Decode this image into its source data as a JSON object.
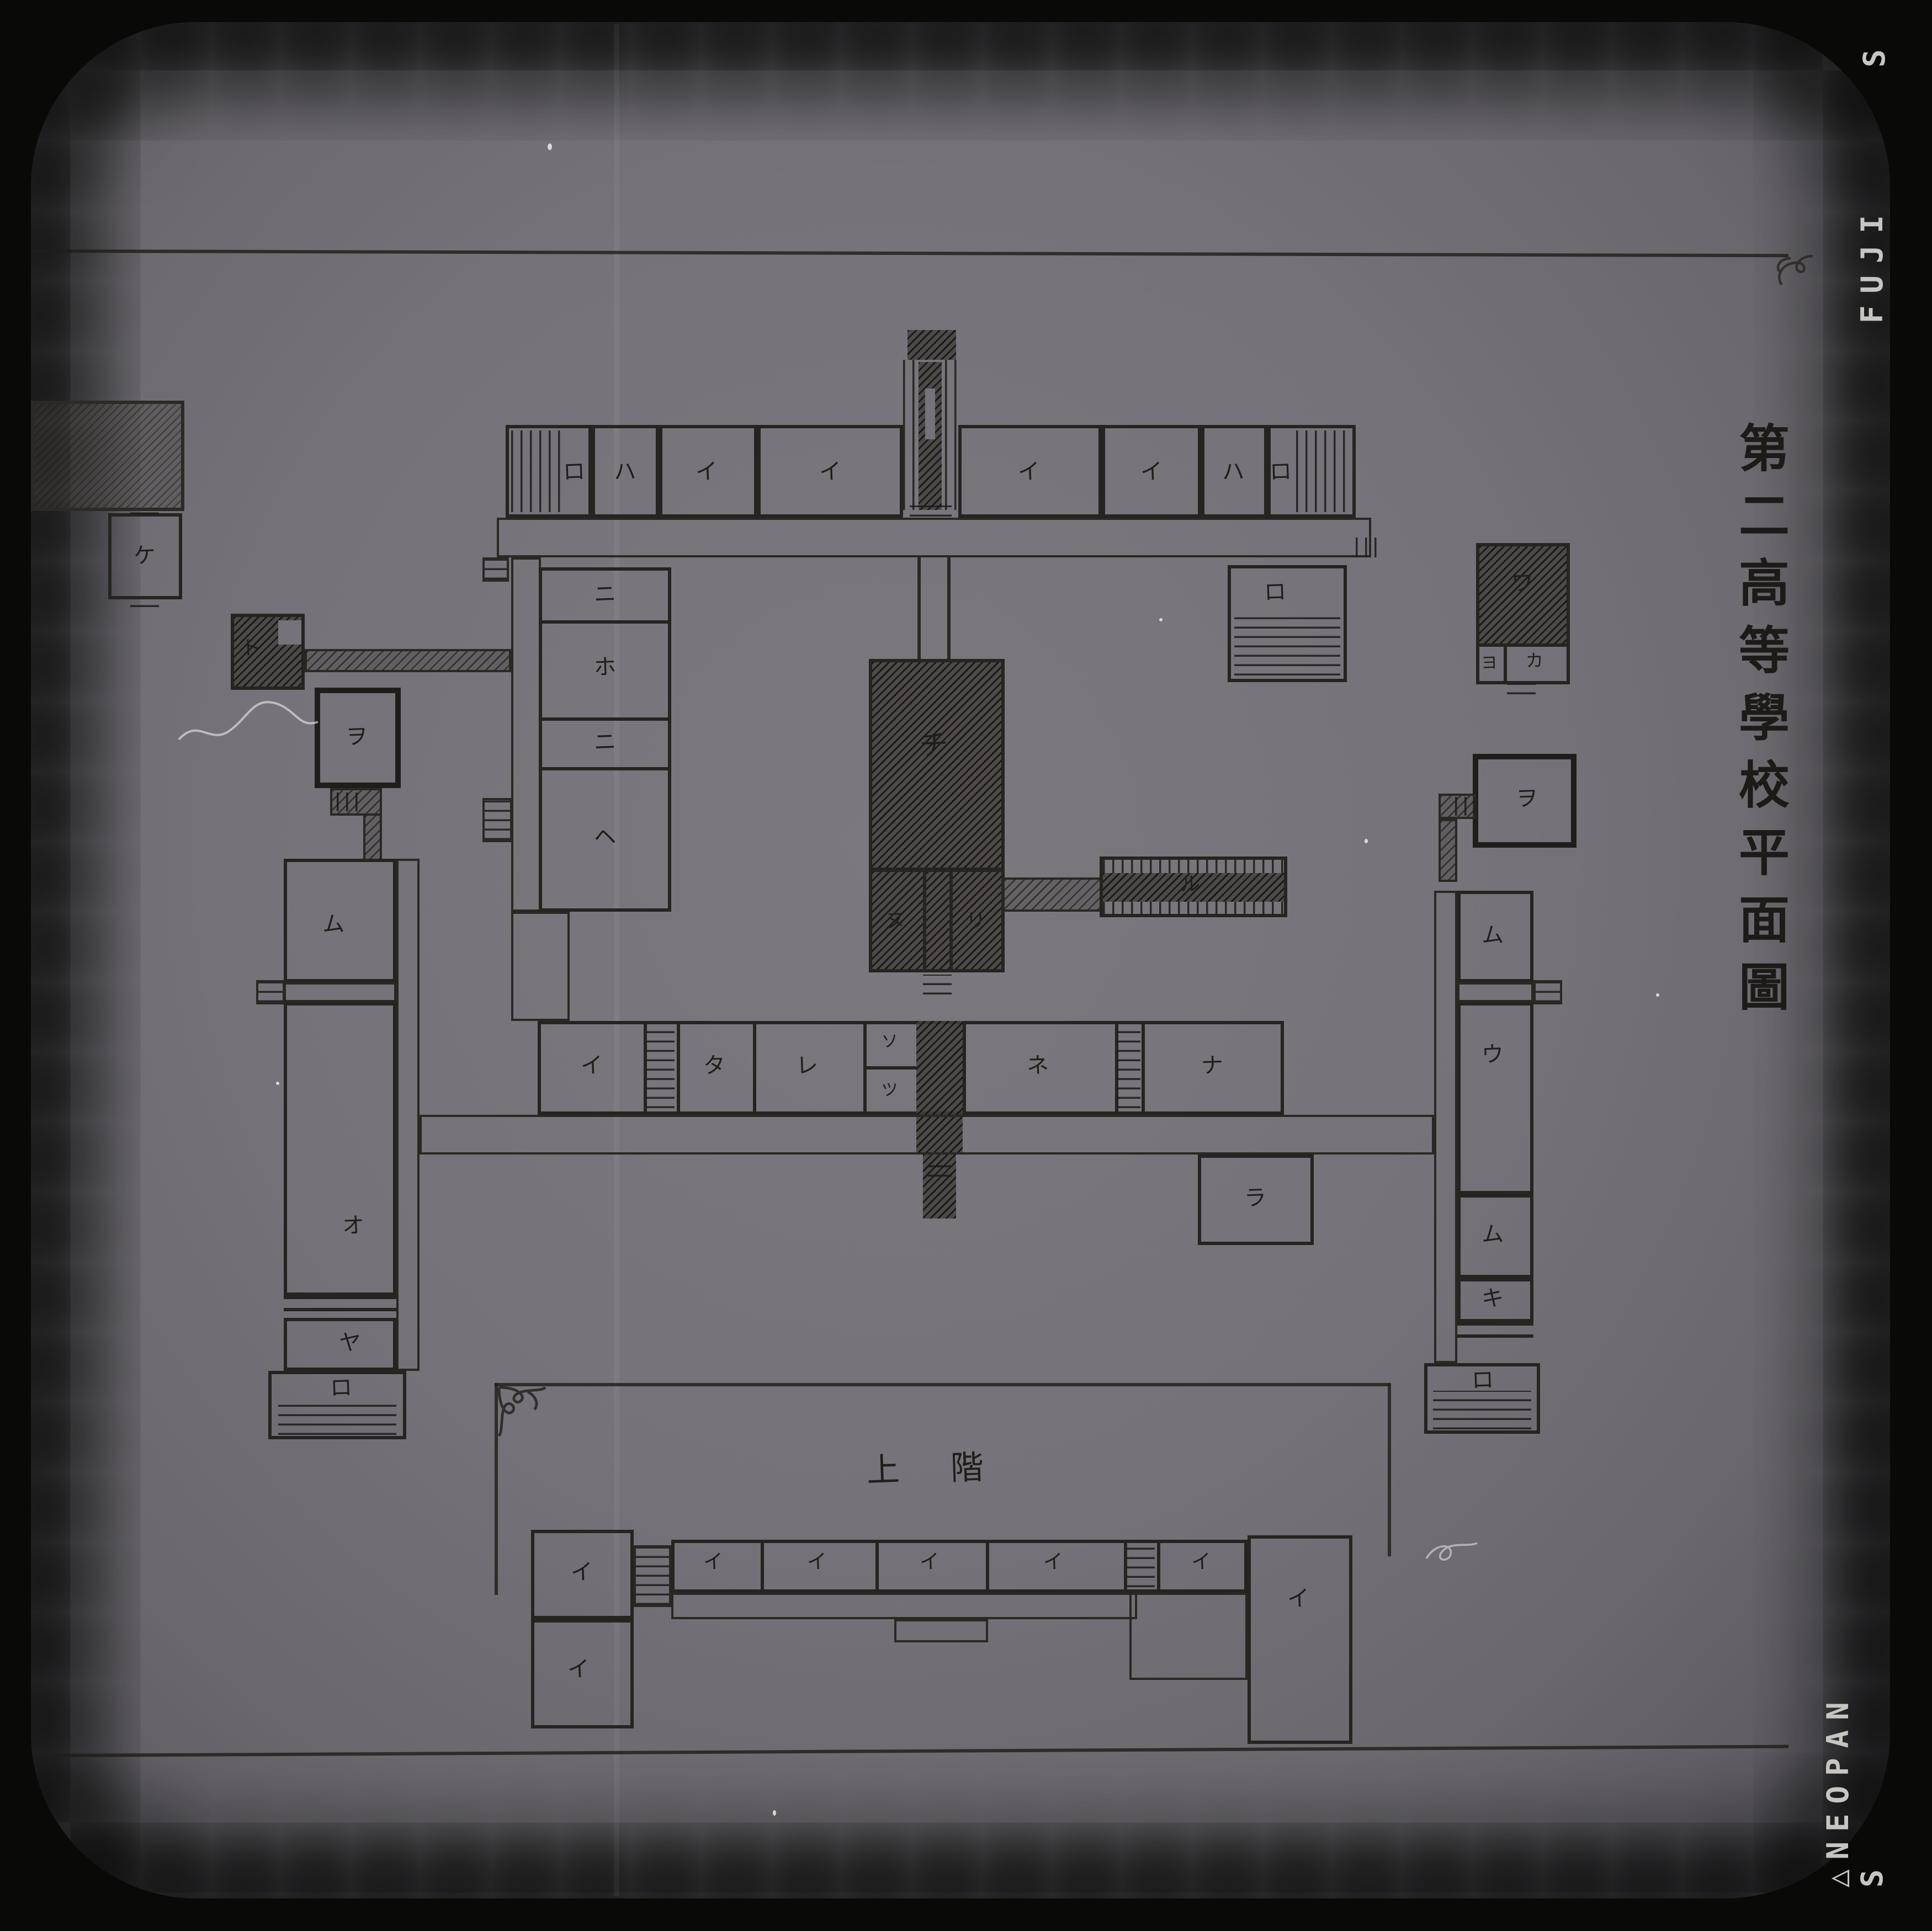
{
  "film": {
    "maker": "FUJI",
    "stock": "△NEOPAN S",
    "edge_partial": "S"
  },
  "title": {
    "text": "第二高等學校平面圖"
  },
  "plan": {
    "floor_note_left": "上",
    "floor_note_right": "階",
    "boxes": [
      [
        "room-ro-northwest",
        "wall",
        458,
        385,
        78,
        84
      ],
      [
        "stairs-stripes-northwest-end",
        "vstripe",
        463,
        390,
        46,
        74
      ],
      [
        "room-ha-northwest",
        "wall",
        536,
        385,
        61,
        84
      ],
      [
        "room-i-north-1",
        "wall",
        597,
        385,
        89,
        84
      ],
      [
        "room-i-north-2",
        "wall",
        686,
        385,
        132,
        84
      ],
      [
        "room-i-north-3",
        "wall",
        868,
        385,
        130,
        84
      ],
      [
        "room-i-north-4",
        "wall",
        998,
        385,
        90,
        84
      ],
      [
        "room-ha-northeast",
        "wall",
        1088,
        385,
        60,
        84
      ],
      [
        "room-ro-northeast",
        "wall",
        1148,
        385,
        80,
        84
      ],
      [
        "stairs-stripes-northeast-end",
        "vstripe",
        1174,
        390,
        48,
        74
      ],
      [
        "corridor-north",
        "wallthin",
        450,
        469,
        792,
        36
      ],
      [
        "stairs-north-left",
        "hstripe-b",
        437,
        505,
        24,
        22
      ],
      [
        "stairs-north-right",
        "vstripe",
        1228,
        487,
        24,
        18
      ],
      [
        "entrance-tower",
        "dark",
        822,
        299,
        44,
        27
      ],
      [
        "entrance-side-left",
        "vstripe",
        818,
        326,
        11,
        136
      ],
      [
        "entrance-side-right",
        "vstripe",
        856,
        326,
        11,
        136
      ],
      [
        "entrance-hall",
        "dark",
        832,
        328,
        21,
        134
      ],
      [
        "entrance-slot",
        "plateBg",
        838,
        352,
        9,
        46
      ],
      [
        "entrance-steps",
        "hstripe",
        824,
        458,
        38,
        10
      ],
      [
        "walkway-wall-left",
        "vline",
        831,
        505,
        3,
        92
      ],
      [
        "walkway-wall-right",
        "vline",
        858,
        505,
        3,
        92
      ],
      [
        "corridor-west-column",
        "wallthin",
        463,
        505,
        27,
        321
      ],
      [
        "corridor-west-column-lower",
        "wallthin",
        463,
        826,
        53,
        99
      ],
      [
        "rooms-west-column",
        "wall",
        488,
        514,
        120,
        312
      ],
      [
        "wall-ni-ho",
        "hwall",
        488,
        562,
        120,
        3
      ],
      [
        "wall-ho-ni",
        "hwall",
        488,
        650,
        120,
        3
      ],
      [
        "wall-ni-he",
        "hwall",
        488,
        695,
        120,
        3
      ],
      [
        "stairs-west-column",
        "hstripe-b",
        437,
        723,
        27,
        40
      ],
      [
        "building-ke",
        "wall",
        98,
        465,
        67,
        78
      ],
      [
        "steps-ke-top",
        "hstripe",
        118,
        458,
        26,
        8
      ],
      [
        "steps-ke-bottom",
        "hstripe",
        118,
        542,
        26,
        8
      ],
      [
        "building-northwest-shed",
        "hatch2b",
        28,
        363,
        139,
        100
      ],
      [
        "building-to",
        "wall dark",
        209,
        556,
        67,
        69
      ],
      [
        "court-to",
        "plateBg",
        252,
        562,
        21,
        22
      ],
      [
        "corridor-to",
        "hatchb",
        276,
        588,
        187,
        21
      ],
      [
        "building-wa-yo-ka",
        "wall",
        1337,
        492,
        85,
        128
      ],
      [
        "room-wa-hatched",
        "dark",
        1340,
        495,
        79,
        88
      ],
      [
        "wall-wa-row",
        "hwall",
        1337,
        583,
        85,
        3
      ],
      [
        "wall-yo-ka",
        "vwall",
        1362,
        583,
        3,
        37
      ],
      [
        "steps-wa",
        "hstripe",
        1365,
        620,
        26,
        9
      ],
      [
        "room-ro-hanging",
        "wall",
        1112,
        512,
        108,
        106
      ],
      [
        "veranda-ro-hanging",
        "hstripe",
        1118,
        556,
        96,
        56
      ],
      [
        "hall-chi",
        "wall dark",
        787,
        597,
        123,
        192
      ],
      [
        "rooms-nu-ri",
        "wall dark",
        787,
        787,
        123,
        94
      ],
      [
        "wall-nu-mid",
        "vwall",
        836,
        787,
        3,
        94
      ],
      [
        "wall-mid-ri",
        "vwall",
        860,
        787,
        3,
        94
      ],
      [
        "steps-chi-south",
        "hstripe",
        836,
        883,
        26,
        18
      ],
      [
        "corridor-ru",
        "hatchb",
        908,
        795,
        90,
        31
      ],
      [
        "building-ru",
        "wall",
        996,
        776,
        170,
        55
      ],
      [
        "ru-window-band-top",
        "vstripe",
        999,
        779,
        164,
        12
      ],
      [
        "ru-hall-center",
        "dark",
        999,
        791,
        164,
        26
      ],
      [
        "ru-window-band-bottom",
        "vstripe",
        999,
        817,
        164,
        11
      ],
      [
        "rooms-middle-wing",
        "wall",
        487,
        925,
        676,
        85
      ],
      [
        "wall-mid-1",
        "vwall",
        583,
        925,
        3,
        85
      ],
      [
        "wall-mid-2",
        "vwall",
        613,
        925,
        3,
        85
      ],
      [
        "wall-mid-3",
        "vwall",
        682,
        925,
        3,
        85
      ],
      [
        "wall-mid-4",
        "vwall",
        782,
        925,
        3,
        85
      ],
      [
        "wall-mid-5",
        "vwall",
        872,
        925,
        3,
        85
      ],
      [
        "wall-mid-6",
        "vwall",
        1010,
        925,
        3,
        85
      ],
      [
        "wall-mid-7",
        "vwall",
        1034,
        925,
        3,
        85
      ],
      [
        "stairs-middle-west",
        "hstripe",
        586,
        932,
        25,
        72
      ],
      [
        "wall-so-tsu",
        "hwall",
        782,
        966,
        48,
        3
      ],
      [
        "connector-middle",
        "dark",
        830,
        925,
        42,
        121
      ],
      [
        "stairs-middle-east",
        "hstripe",
        1012,
        932,
        21,
        72
      ],
      [
        "corridor-middle",
        "wallthin",
        380,
        1010,
        919,
        36
      ],
      [
        "porch-middle-south",
        "dark",
        836,
        1046,
        30,
        58
      ],
      [
        "steps-porch-middle",
        "hstripe",
        840,
        1050,
        22,
        16
      ],
      [
        "room-ra",
        "wall",
        1085,
        1046,
        105,
        82
      ],
      [
        "room-wo-west",
        "wallthick",
        285,
        623,
        78,
        91
      ],
      [
        "connector-wo-west-a",
        "hatchb",
        299,
        714,
        47,
        25
      ],
      [
        "steps-wo-west",
        "vstripe",
        305,
        718,
        22,
        17
      ],
      [
        "connector-wo-west-b",
        "hatchb",
        329,
        737,
        17,
        43
      ],
      [
        "room-mu-west",
        "wall",
        257,
        778,
        102,
        112
      ],
      [
        "corridor-west-wing",
        "wallthin",
        359,
        778,
        21,
        464
      ],
      [
        "corridor-cross-west",
        "wallthin",
        257,
        890,
        102,
        18
      ],
      [
        "stairs-cross-west",
        "hstripe-b",
        232,
        888,
        26,
        22
      ],
      [
        "room-o-west",
        "wall",
        257,
        908,
        102,
        266
      ],
      [
        "band-west-1",
        "hwall",
        257,
        1174,
        102,
        3
      ],
      [
        "band-west-2",
        "hwall",
        257,
        1185,
        102,
        3
      ],
      [
        "room-ya",
        "wall",
        257,
        1194,
        102,
        48
      ],
      [
        "room-ro-southwest",
        "wall",
        243,
        1242,
        125,
        62
      ],
      [
        "veranda-ro-southwest",
        "hstripe",
        252,
        1268,
        107,
        32
      ],
      [
        "room-wo-east",
        "wallthick",
        1334,
        683,
        94,
        85
      ],
      [
        "connector-wo-east-a",
        "hatchb",
        1303,
        719,
        34,
        23
      ],
      [
        "steps-wo-east",
        "vstripe",
        1318,
        722,
        18,
        17
      ],
      [
        "connector-wo-east-b",
        "hatchb",
        1303,
        742,
        17,
        57
      ],
      [
        "room-mu-east-upper",
        "wall",
        1320,
        807,
        69,
        83
      ],
      [
        "corridor-east-wing",
        "wallthin",
        1299,
        807,
        21,
        428
      ],
      [
        "corridor-cross-east",
        "wallthin",
        1320,
        890,
        69,
        18
      ],
      [
        "stairs-cross-east",
        "hstripe-b",
        1389,
        888,
        26,
        22
      ],
      [
        "room-u-east",
        "wall",
        1320,
        908,
        69,
        174
      ],
      [
        "room-mu-east-lower",
        "wall",
        1320,
        1082,
        69,
        76
      ],
      [
        "room-ki-east",
        "wall",
        1320,
        1158,
        69,
        40
      ],
      [
        "band-east-1",
        "hwall",
        1320,
        1198,
        69,
        3
      ],
      [
        "band-east-2",
        "hwall",
        1320,
        1209,
        69,
        3
      ],
      [
        "room-ro-southeast",
        "wall",
        1290,
        1235,
        105,
        64
      ],
      [
        "veranda-ro-southeast",
        "hstripe",
        1298,
        1260,
        89,
        35
      ],
      [
        "rule-south-box-top",
        "inkline",
        448,
        1253,
        811,
        2.5
      ],
      [
        "rule-south-box-left",
        "inkline",
        448,
        1253,
        2.5,
        192
      ],
      [
        "rule-south-box-right",
        "inkline",
        1257,
        1253,
        2.5,
        157
      ],
      [
        "room-i-sw-upper",
        "wall",
        481,
        1386,
        93,
        81
      ],
      [
        "room-i-sw-lower",
        "wall",
        481,
        1467,
        93,
        99
      ],
      [
        "stairs-south-west",
        "hstripe-b",
        574,
        1400,
        34,
        56
      ],
      [
        "rooms-south-row",
        "wall",
        608,
        1395,
        522,
        48
      ],
      [
        "wall-south-1",
        "vwall",
        689,
        1395,
        3,
        48
      ],
      [
        "wall-south-2",
        "vwall",
        793,
        1395,
        3,
        48
      ],
      [
        "wall-south-3",
        "vwall",
        893,
        1395,
        3,
        48
      ],
      [
        "wall-south-4",
        "vwall",
        1018,
        1395,
        3,
        48
      ],
      [
        "wall-south-5",
        "vwall",
        1048,
        1395,
        3,
        48
      ],
      [
        "stairs-south-mid",
        "hstripe",
        1021,
        1400,
        25,
        38
      ],
      [
        "corridor-south",
        "wallthin",
        608,
        1443,
        422,
        24
      ],
      [
        "porch-south",
        "wallthin",
        810,
        1467,
        85,
        21
      ],
      [
        "corridor-south-jog",
        "wallthin",
        1023,
        1443,
        107,
        79
      ],
      [
        "room-i-se-large",
        "wall",
        1130,
        1391,
        95,
        189
      ]
    ],
    "labels": [
      [
        "ロ",
        520,
        427,
        20
      ],
      [
        "ハ",
        566,
        427,
        20
      ],
      [
        "イ",
        640,
        427,
        20
      ],
      [
        "イ",
        752,
        427,
        20
      ],
      [
        "イ",
        932,
        427,
        20
      ],
      [
        "イ",
        1043,
        427,
        20
      ],
      [
        "ハ",
        1117,
        427,
        20
      ],
      [
        "ロ",
        1160,
        427,
        20
      ],
      [
        "ニ",
        548,
        538,
        20
      ],
      [
        "ホ",
        548,
        604,
        20
      ],
      [
        "ニ",
        548,
        672,
        20
      ],
      [
        "ヘ",
        548,
        758,
        20
      ],
      [
        "ケ",
        131,
        503,
        20
      ],
      [
        "ト",
        227,
        588,
        18
      ],
      [
        "ロ",
        1155,
        536,
        20
      ],
      [
        "ワ",
        1379,
        528,
        20
      ],
      [
        "ヨ",
        1349,
        601,
        15
      ],
      [
        "カ",
        1390,
        599,
        16
      ],
      [
        "チ",
        846,
        676,
        26
      ],
      [
        "ヌ",
        811,
        835,
        18
      ],
      [
        "リ",
        884,
        835,
        18
      ],
      [
        "ル",
        1078,
        802,
        18
      ],
      [
        "イ",
        536,
        965,
        20
      ],
      [
        "タ",
        647,
        965,
        20
      ],
      [
        "レ",
        731,
        965,
        20
      ],
      [
        "ソ",
        806,
        944,
        15
      ],
      [
        "ツ",
        806,
        988,
        15
      ],
      [
        "ネ",
        940,
        965,
        20
      ],
      [
        "ナ",
        1098,
        965,
        20
      ],
      [
        "ラ",
        1137,
        1085,
        20
      ],
      [
        "ヲ",
        323,
        667,
        20
      ],
      [
        "ム",
        302,
        837,
        20
      ],
      [
        "オ",
        320,
        1110,
        20
      ],
      [
        "ヤ",
        317,
        1216,
        20
      ],
      [
        "ロ",
        309,
        1257,
        20
      ],
      [
        "ヲ",
        1383,
        723,
        20
      ],
      [
        "ム",
        1352,
        847,
        20
      ],
      [
        "ウ",
        1352,
        955,
        20
      ],
      [
        "ム",
        1352,
        1118,
        20
      ],
      [
        "キ",
        1352,
        1176,
        20
      ],
      [
        "ロ",
        1343,
        1250,
        20
      ],
      [
        "上",
        800,
        1333,
        30
      ],
      [
        "階",
        876,
        1331,
        30
      ],
      [
        "イ",
        527,
        1424,
        20
      ],
      [
        "イ",
        524,
        1512,
        20
      ],
      [
        "イ",
        646,
        1416,
        18
      ],
      [
        "イ",
        740,
        1416,
        18
      ],
      [
        "イ",
        842,
        1416,
        18
      ],
      [
        "イ",
        954,
        1416,
        18
      ],
      [
        "イ",
        1088,
        1416,
        18
      ],
      [
        "イ",
        1176,
        1448,
        20
      ]
    ]
  }
}
